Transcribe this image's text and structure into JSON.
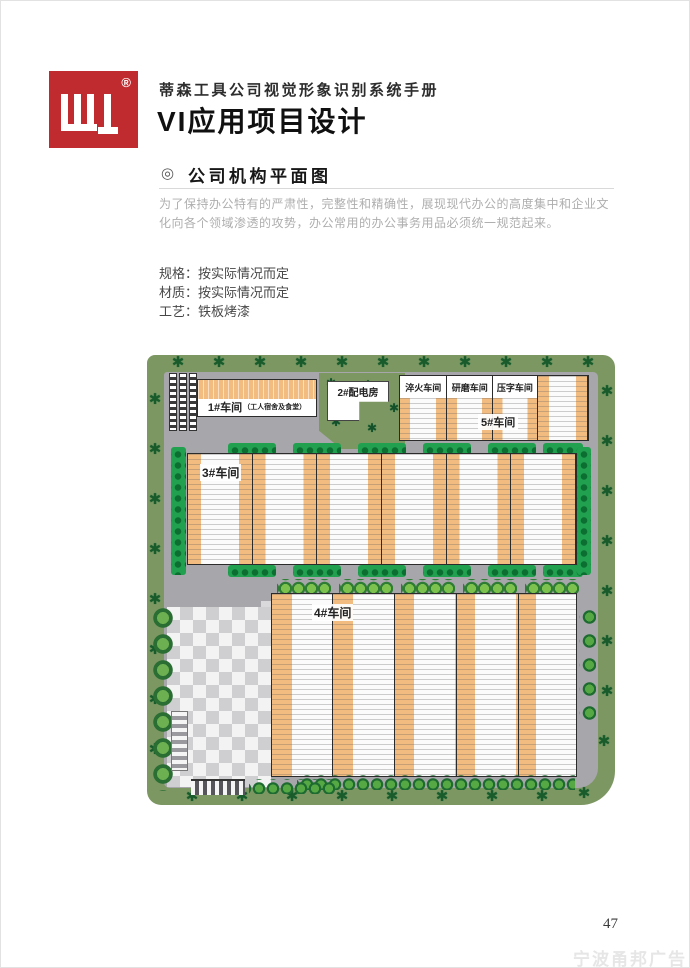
{
  "header": {
    "registered": "®",
    "manual_title": "蒂森工具公司视觉形象识别系统手册",
    "page_title": "VI应用项目设计"
  },
  "section": {
    "marker": "◎",
    "heading": "公司机构平面图",
    "description": "为了保持办公特有的严肃性，完整性和精确性，展现现代办公的高度集中和企业文化向各个领域渗透的攻势，办公常用的办公事务用品必须统一规范起来。",
    "specs": [
      "规格：按实际情况而定",
      "材质：按实际情况而定",
      "工艺：铁板烤漆"
    ]
  },
  "plan": {
    "b1_label": "1#车间",
    "b1_sub": "（工人宿舍及食堂）",
    "b2_label": "2#配电房",
    "b5_bay1": "淬火车间",
    "b5_bay2": "研磨车间",
    "b5_bay3": "压字车间",
    "b5_label": "5#车间",
    "b3_label": "3#车间",
    "b4_label": "4#车间"
  },
  "footer": {
    "page_number": "47",
    "watermark": "宁波甬邦广告"
  },
  "icons": {
    "tree": "✱",
    "section_marker": "◎"
  },
  "colors": {
    "brand_red": "#bf2b2f",
    "perimeter_green": "#7d9763",
    "road_gray": "#a7a7ab",
    "roof_orange": "#f2bb7f",
    "hedge_green": "#21a050",
    "tree_green": "#1a5b2c"
  }
}
